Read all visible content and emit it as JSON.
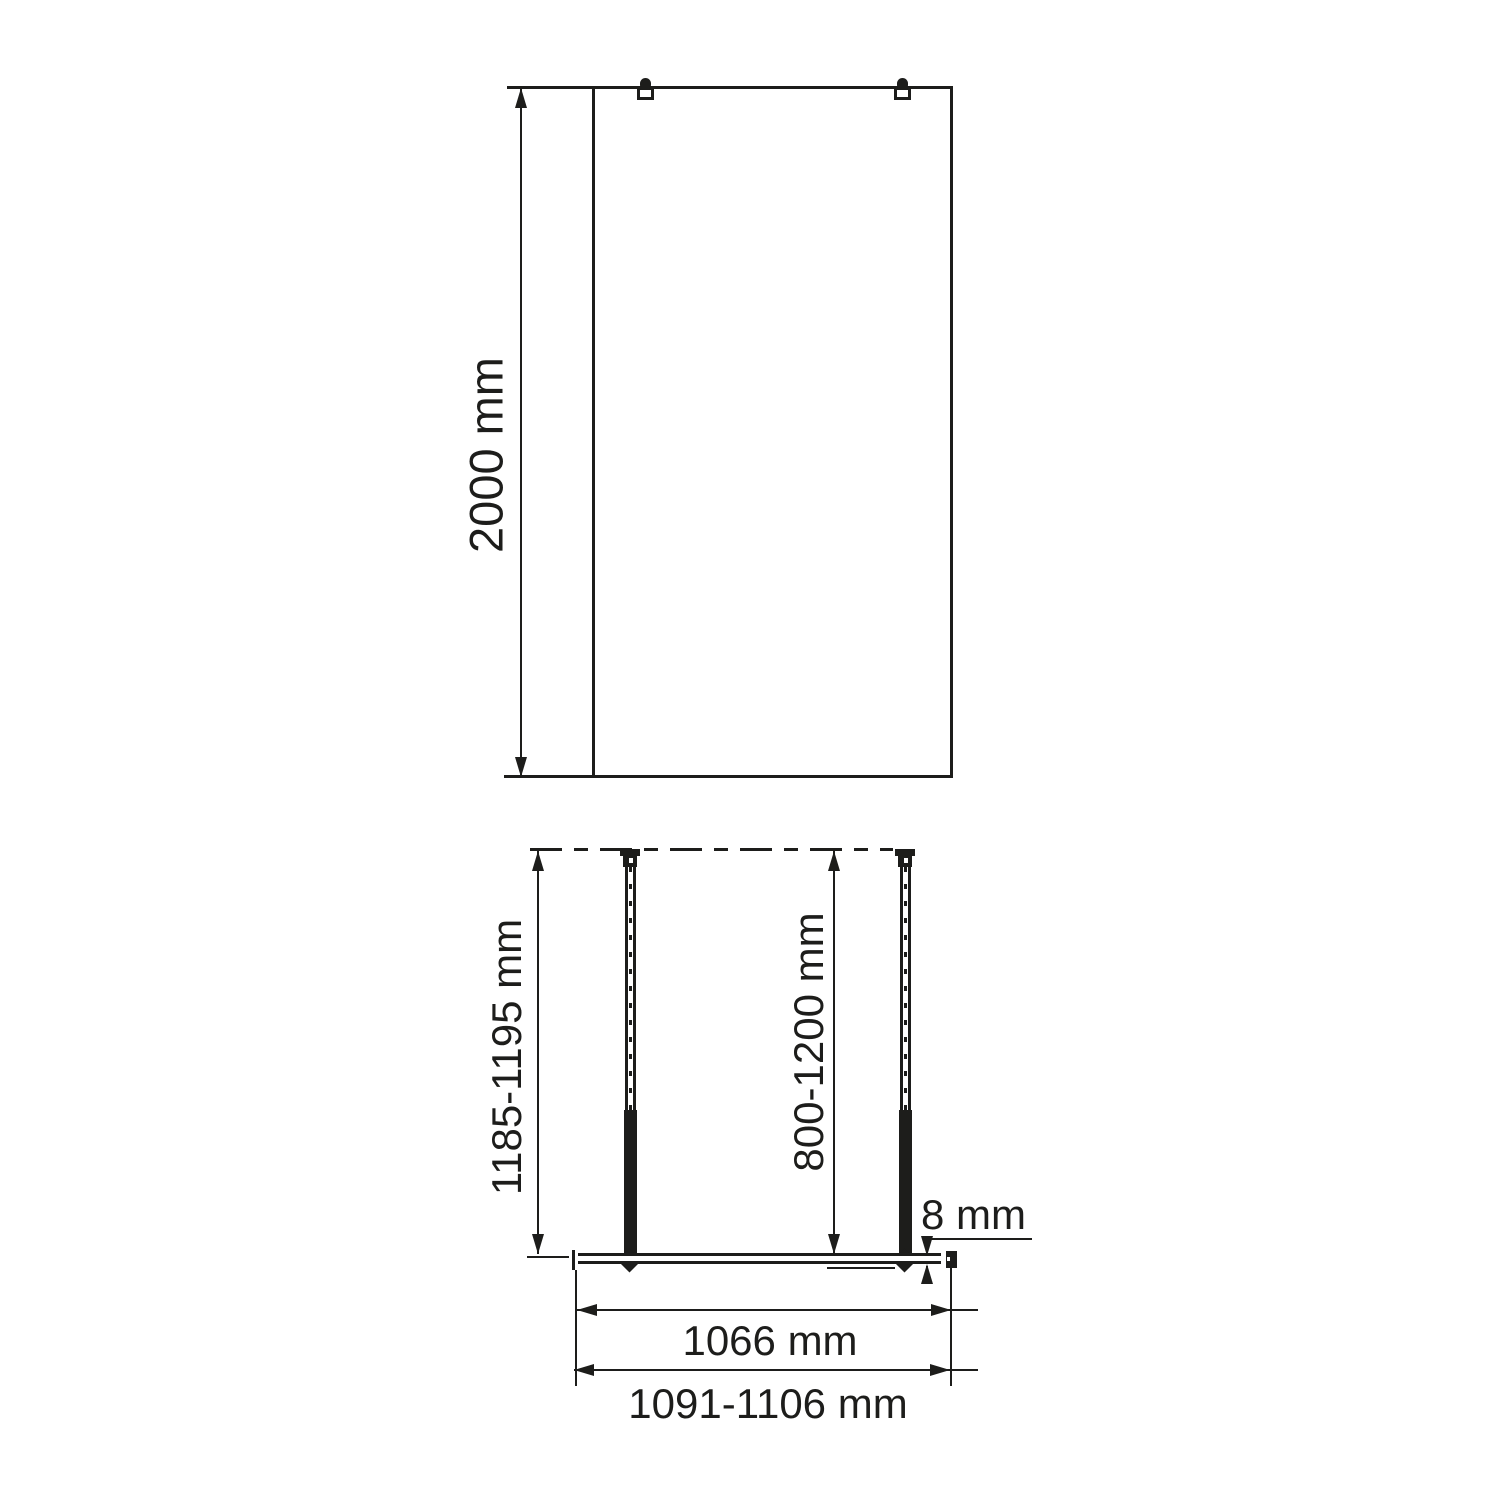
{
  "drawing": {
    "front_view": {
      "height_dimension": "2000 mm"
    },
    "plan_view": {
      "left_support_dimension": "1185-1195 mm",
      "right_support_dimension": "800-1200 mm",
      "glass_thickness": "8 mm",
      "inner_width_dimension": "1066 mm",
      "overall_width_dimension": "1091-1106 mm"
    },
    "colors": {
      "line": "#1d1d1b",
      "background": "#ffffff"
    }
  }
}
